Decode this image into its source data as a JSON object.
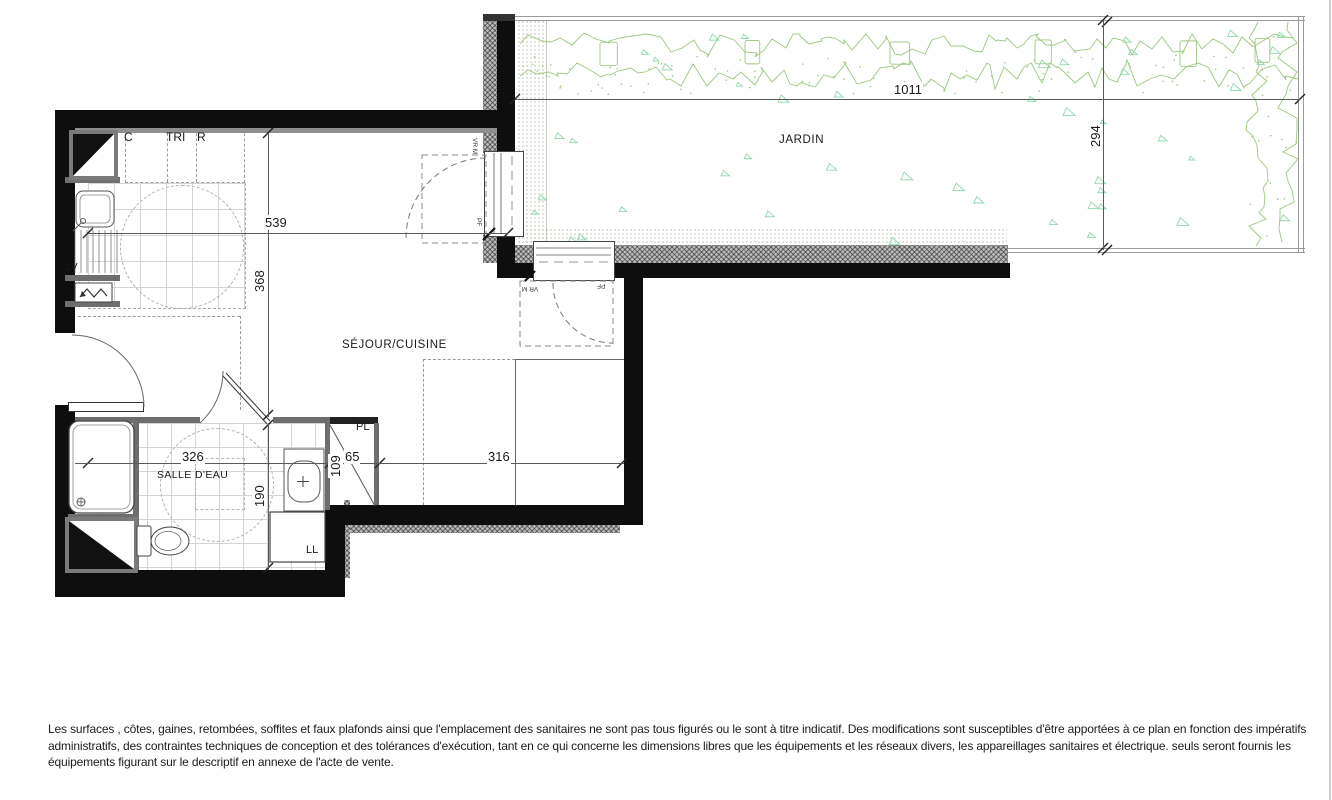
{
  "rooms": {
    "garden": "JARDIN",
    "living_kitchen": "SÉJOUR/CUISINE",
    "bathroom": "SALLE D'EAU"
  },
  "labels": {
    "cupboard": "C",
    "sorting": "TRI",
    "fridge": "R",
    "dishwasher": "LV",
    "washing_machine": "LL",
    "closet": "PL",
    "french_door_side": "PF",
    "shutter_side": "VR M",
    "french_door_front": "PF",
    "shutter_front": "VR M"
  },
  "dimensions": {
    "garden_width": "1011",
    "garden_depth": "294",
    "kitchen_width": "539",
    "living_depth": "368",
    "bathroom_width": "326",
    "bathroom_depth": "190",
    "duct_depth": "109",
    "closet_width": "65",
    "living_width": "316"
  },
  "disclaimer": {
    "line1": "Les surfaces , côtes, gaines, retombées, soffites et faux plafonds ainsi que l'emplacement des sanitaires ne sont pas tous figurés ou le sont à titre indicatif. Des modifications sont susceptibles d'être apportées à ce plan en fonction des impératifs",
    "line2": "administratifs, des contraintes techniques de conception et des tolérances d'exécution, tant en ce qui concerne les dimensions libres que les équipements et les réseaux divers, les appareillages sanitaires et électrique. seuls seront fournis les",
    "line3": "équipements figurant sur le descriptif en annexe de l'acte de vente."
  },
  "colors": {
    "wall": "#0e0e0e",
    "partition": "#6e6e6e",
    "hedge_green": "#9bc87f",
    "grass_green": "#8fd6ad",
    "dimension": "#5a5a5a"
  }
}
